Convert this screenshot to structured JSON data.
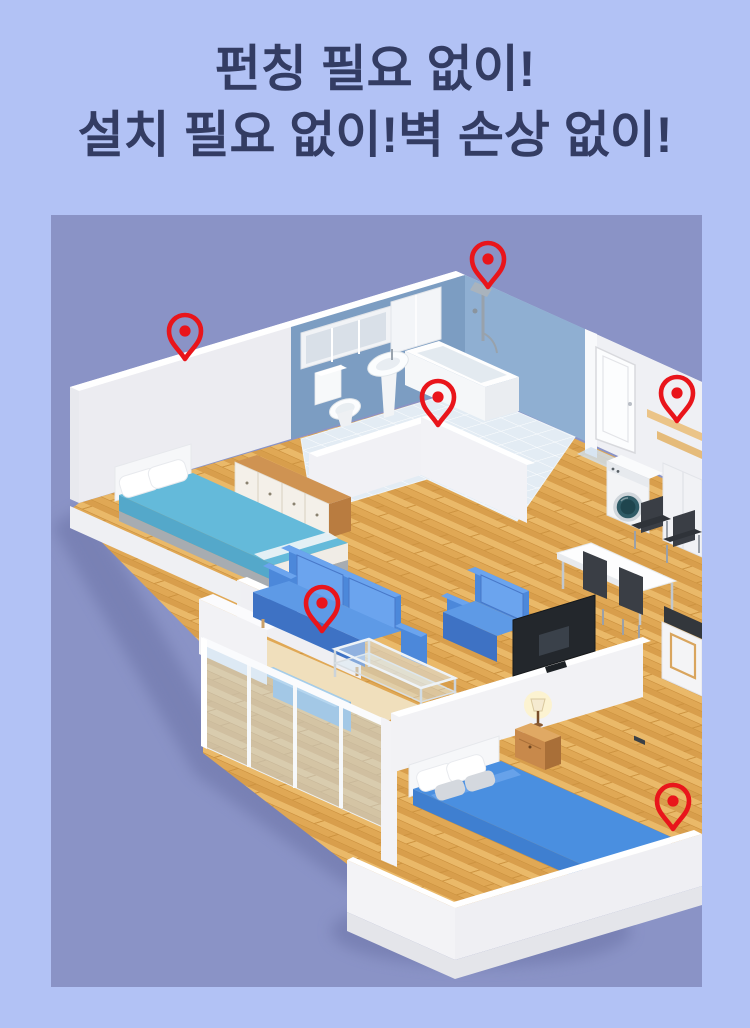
{
  "page": {
    "background_color": "#b2c2f5"
  },
  "headline": {
    "line1": "펀칭 필요 없이!",
    "line2": "설치 필요 없이!벽 손상 없이!",
    "text_color": "#333c63"
  },
  "illustration": {
    "type": "isometric-apartment-floorplan",
    "background_color": "#8a93c6",
    "pin_color": "#e9151b",
    "pins": [
      {
        "id": 1,
        "location": "bathroom back wall corner",
        "transform": "translate(437,72)"
      },
      {
        "id": 2,
        "location": "bedroom back wall top edge",
        "transform": "translate(134,144)"
      },
      {
        "id": 3,
        "location": "kitchen wood shelf",
        "transform": "translate(626,206)"
      },
      {
        "id": 4,
        "location": "bathroom partition half-wall",
        "transform": "translate(387,210)"
      },
      {
        "id": 5,
        "location": "living room sofa",
        "transform": "translate(271,416)"
      },
      {
        "id": 6,
        "location": "master bedroom floor",
        "transform": "translate(622,614)"
      }
    ],
    "rooms": [
      "bedroom",
      "bathroom",
      "hallway",
      "kitchen",
      "dining-area",
      "living-room",
      "balcony",
      "master-bedroom"
    ]
  }
}
